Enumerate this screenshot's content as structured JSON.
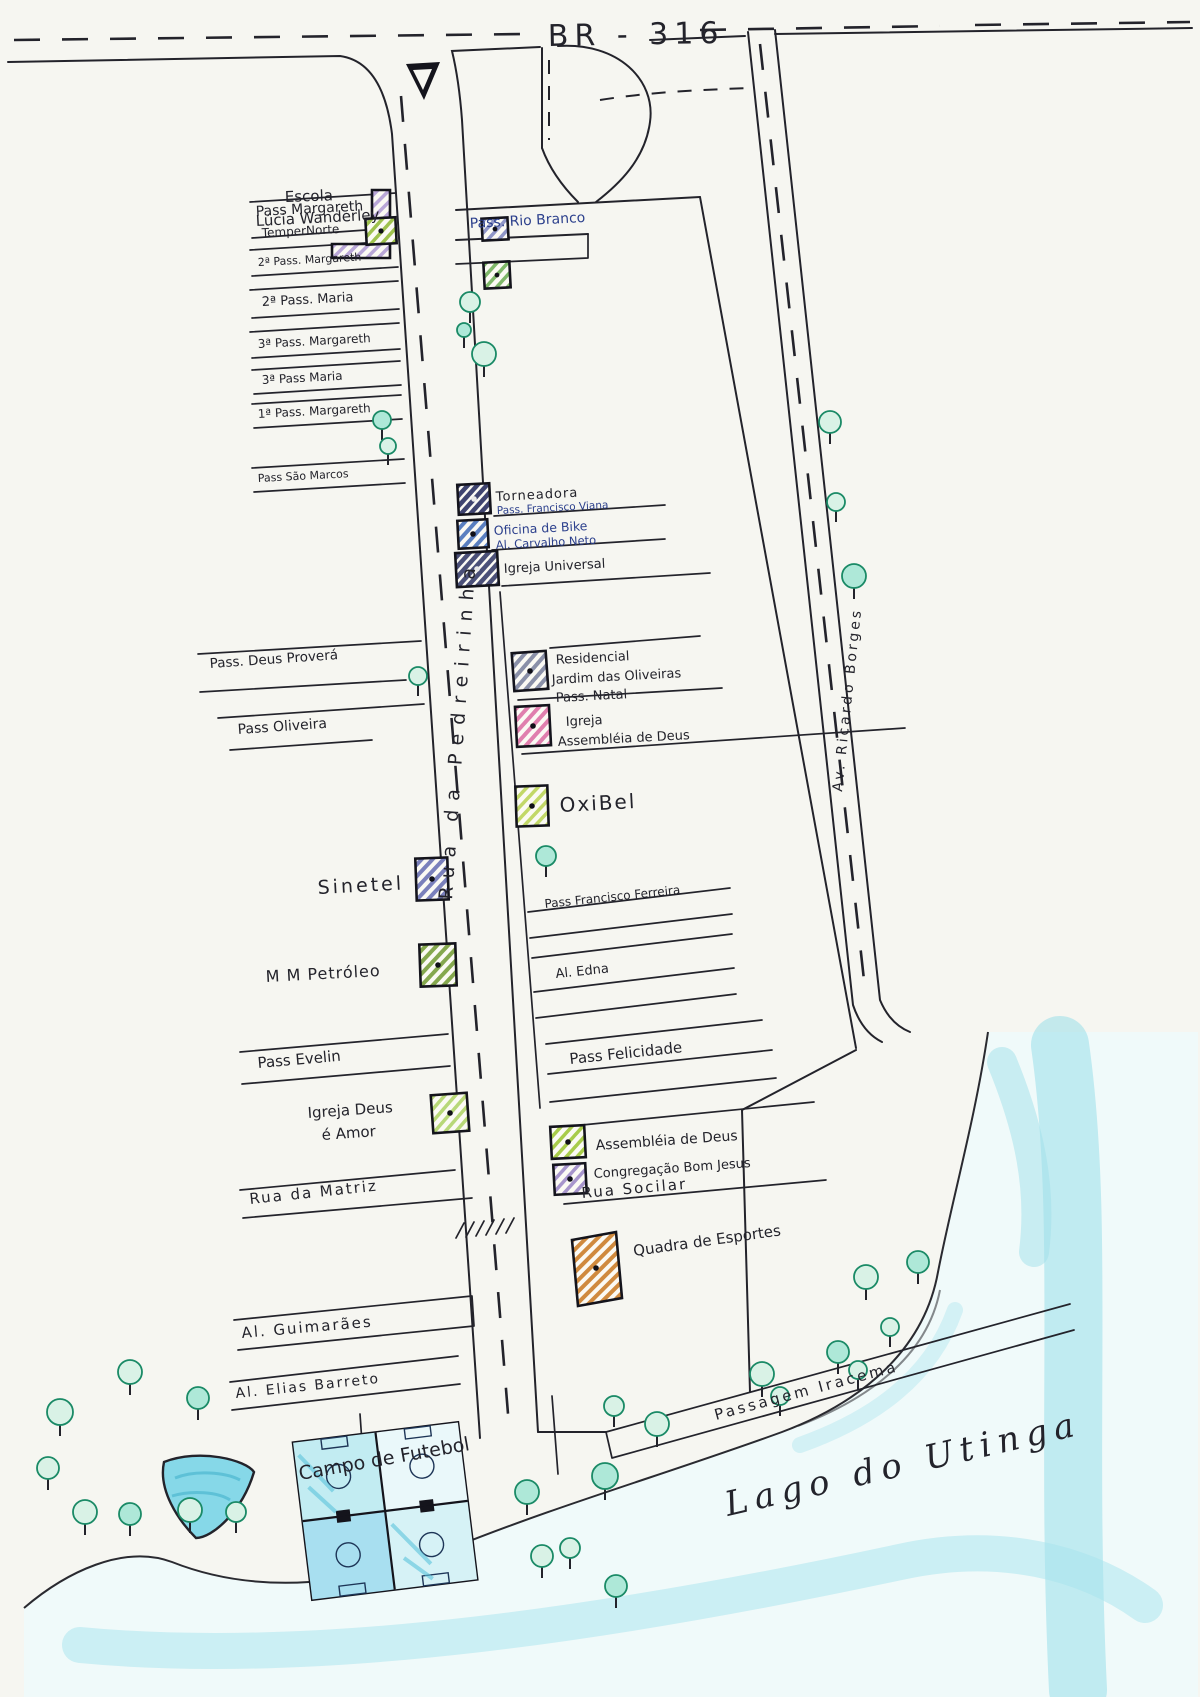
{
  "map_title": "Mapa do bairro - BR-316 / Rua da Pedreirinha",
  "roads": {
    "br316": "BR - 316",
    "rua_pedreirinha": "Rua da Pedreirinha",
    "av_ricardo_borges": "Av. Ricardo Borges",
    "pass_rio_branco": "Pass. Rio Branco",
    "pass_margareth": "Pass Margareth",
    "pass_margareth_2": "2ª Pass. Margareth",
    "pass_maria_2": "2ª Pass. Maria",
    "pass_margareth_3": "3ª Pass. Margareth",
    "pass_maria_3": "3ª Pass Maria",
    "pass_margareth_1": "1ª Pass. Margareth",
    "pass_sao_marcos": "Pass São Marcos",
    "pass_francisco_viana": "Pass. Francisco Viana",
    "al_carvalho_neto": "Al. Carvalho Neto",
    "pass_deus_provera": "Pass. Deus Proverá",
    "pass_natal": "Pass. Natal",
    "pass_oliveira": "Pass Oliveira",
    "pass_francisco_ferreira": "Pass Francisco Ferreira",
    "al_edna": "Al. Edna",
    "pass_evelin": "Pass Evelin",
    "pass_felicidade": "Pass Felicidade",
    "rua_da_matriz": "Rua da Matriz",
    "rua_socilar": "Rua Socilar",
    "al_guimaraes": "Al. Guimarães",
    "al_elias_barreto": "Al. Elias Barreto",
    "passagem_iracema": "Passagem Iracema"
  },
  "places": {
    "escola_line1": "Escola",
    "escola_line2": "Lúcia Wanderley",
    "tempernorte": "TemperNorte",
    "torneadora": "Torneadora",
    "oficina_de_bike": "Oficina de Bike",
    "igreja_universal": "Igreja Universal",
    "residencial_line1": "Residencial",
    "residencial_line2": "Jardim das Oliveiras",
    "igreja_assembleia_line1": "Igreja",
    "igreja_assembleia_line2": "Assembléia de Deus",
    "oxibel": "OxiBel",
    "sinetel": "Sinetel",
    "mm_petroleo": "M M Petróleo",
    "igreja_deus_amor_line1": "Igreja Deus",
    "igreja_deus_amor_line2": "é Amor",
    "assembleia_de_deus": "Assembléia de Deus",
    "congregacao_bom_jesus": "Congregação Bom Jesus",
    "quadra_de_esportes": "Quadra de Esportes",
    "campo_de_futebol": "Campo de Futebol",
    "lago_do_utinga": "Lago do Utinga"
  },
  "colors": {
    "ink": "#23232b",
    "blue_ink": "#2b3f8c",
    "water": "#86d8e8",
    "tree": "#1a8a66",
    "escola": "#b9a7d8",
    "tempernorte": "#9fc24e",
    "small_bld_1": "#8f96c8",
    "small_bld_2": "#7fb86a",
    "torneadora": "#3f4470",
    "oficina_de_bike": "#5a7fc0",
    "igreja_universal": "#4b5078",
    "residencial": "#8a90a8",
    "igreja_assembleia": "#e07fae",
    "oxibel": "#c2d868",
    "sinetel": "#7a80bb",
    "mm_petroleo": "#85a84e",
    "igreja_deus_amor": "#b8d878",
    "assembleia_de_deus": "#a8cc4a",
    "congregacao_bom_jesus": "#a795cc",
    "quadra_de_esportes": "#d08a3e"
  }
}
